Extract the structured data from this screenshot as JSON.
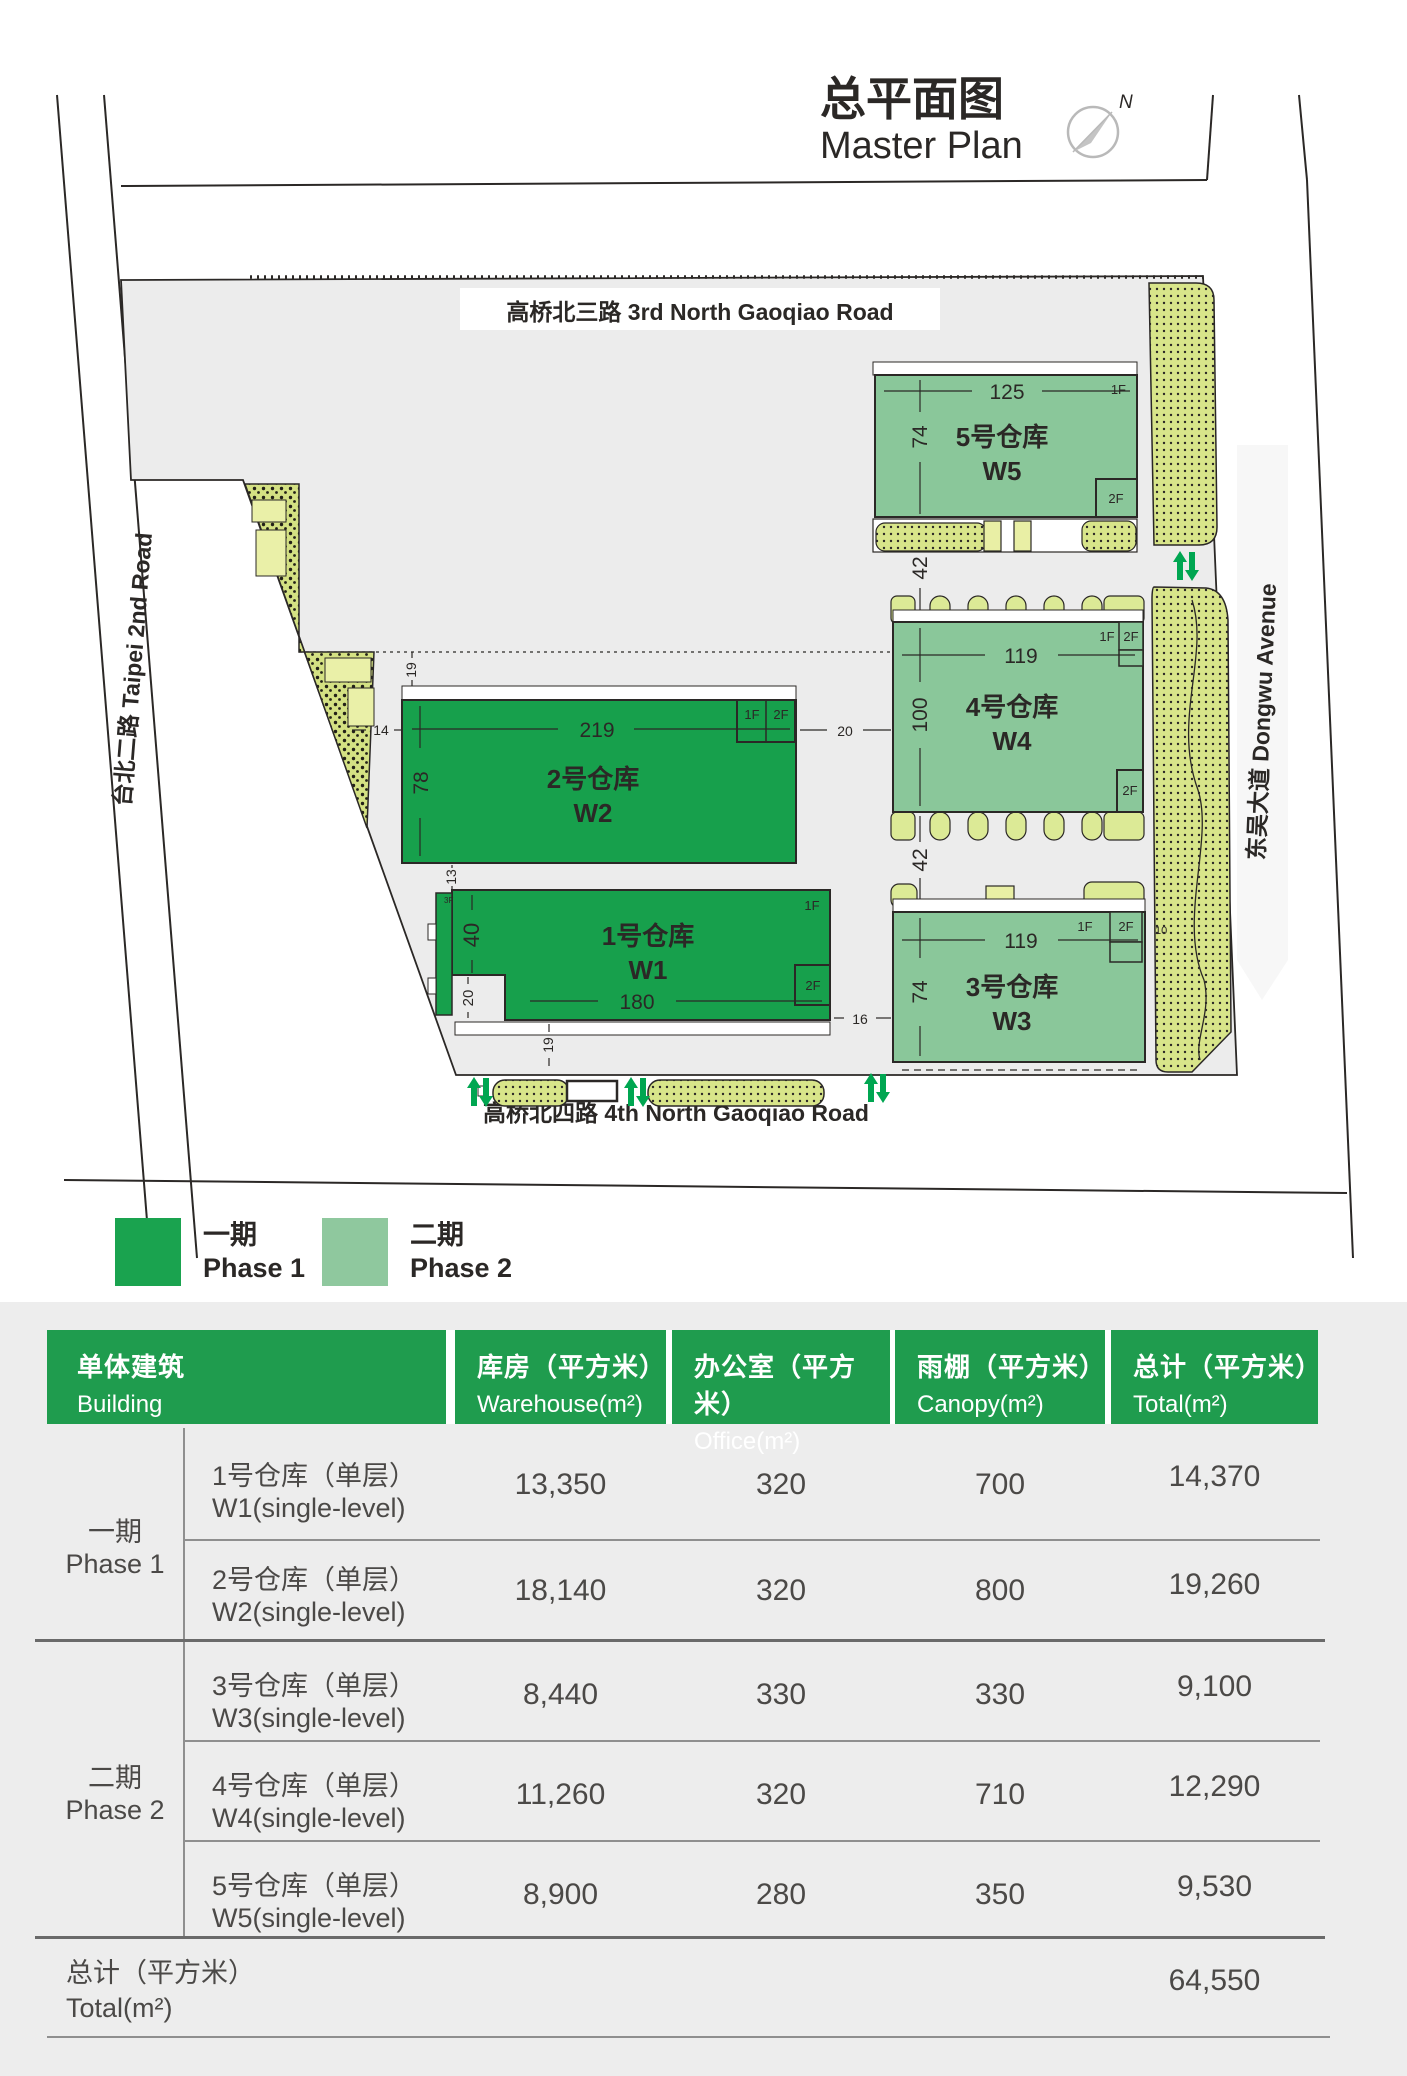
{
  "title": {
    "zh": "总平面图",
    "en": "Master Plan",
    "compass": "N"
  },
  "roads": {
    "north": "高桥北三路 3rd North Gaoqiao Road",
    "south": "高桥北四路 4th North Gaoqiao Road",
    "west": "台北二路 Taipei 2nd Road",
    "east": "东吴大道 Dongwu Avenue"
  },
  "plan": {
    "w1": {
      "name": "1号仓库",
      "code": "W1",
      "dim_len": "180",
      "dim_depth": "40",
      "dim_d2": "20",
      "dim_below": "19",
      "dim_above": "13",
      "f1": "1F",
      "f2": "2F",
      "f3": "3F"
    },
    "w2": {
      "name": "2号仓库",
      "code": "W2",
      "dim_len": "219",
      "dim_depth": "78",
      "dim_left": "14",
      "dim_top": "19",
      "dim_right": "20",
      "f1": "1F",
      "f2": "2F"
    },
    "w3": {
      "name": "3号仓库",
      "code": "W3",
      "dim_len": "119",
      "dim_depth": "74",
      "dim_left": "16",
      "dim_right": "10",
      "f1": "1F",
      "f2": "2F"
    },
    "w4": {
      "name": "4号仓库",
      "code": "W4",
      "dim_len": "119",
      "dim_depth": "100",
      "dim_below": "42",
      "f1": "1F",
      "f2": "2F",
      "f2b": "2F"
    },
    "w5": {
      "name": "5号仓库",
      "code": "W5",
      "dim_len": "125",
      "dim_depth": "74",
      "dim_below": "42",
      "f1": "1F",
      "f2": "2F"
    }
  },
  "legend": {
    "phase1": {
      "zh": "一期",
      "en": "Phase 1",
      "color": "#1aa34f"
    },
    "phase2": {
      "zh": "二期",
      "en": "Phase 2",
      "color": "#8fc89e"
    }
  },
  "table": {
    "colors": {
      "header_bg": "#1f9c4e",
      "body_bg": "#ededed",
      "phase1_green": "#17a04c",
      "phase2_green": "#8ac79a"
    },
    "headers": {
      "building": {
        "zh": "单体建筑",
        "en": "Building"
      },
      "warehouse": {
        "zh": "库房（平方米）",
        "en": "Warehouse(m²)"
      },
      "office": {
        "zh": "办公室（平方米）",
        "en": "Office(m²)"
      },
      "canopy": {
        "zh": "雨棚（平方米）",
        "en": "Canopy(m²)"
      },
      "total": {
        "zh": "总计（平方米）",
        "en": "Total(m²)"
      }
    },
    "groups": [
      {
        "phase_zh": "一期",
        "phase_en": "Phase 1",
        "rows": [
          {
            "zh": "1号仓库（单层）",
            "en": "W1(single-level)",
            "warehouse": "13,350",
            "office": "320",
            "canopy": "700",
            "total": "14,370"
          },
          {
            "zh": "2号仓库（单层）",
            "en": "W2(single-level)",
            "warehouse": "18,140",
            "office": "320",
            "canopy": "800",
            "total": "19,260"
          }
        ]
      },
      {
        "phase_zh": "二期",
        "phase_en": "Phase 2",
        "rows": [
          {
            "zh": "3号仓库（单层）",
            "en": "W3(single-level)",
            "warehouse": "8,440",
            "office": "330",
            "canopy": "330",
            "total": "9,100"
          },
          {
            "zh": "4号仓库（单层）",
            "en": "W4(single-level)",
            "warehouse": "11,260",
            "office": "320",
            "canopy": "710",
            "total": "12,290"
          },
          {
            "zh": "5号仓库（单层）",
            "en": "W5(single-level)",
            "warehouse": "8,900",
            "office": "280",
            "canopy": "350",
            "total": "9,530"
          }
        ]
      }
    ],
    "footer": {
      "zh": "总计（平方米）",
      "en": "Total(m²)",
      "value": "64,550"
    }
  }
}
